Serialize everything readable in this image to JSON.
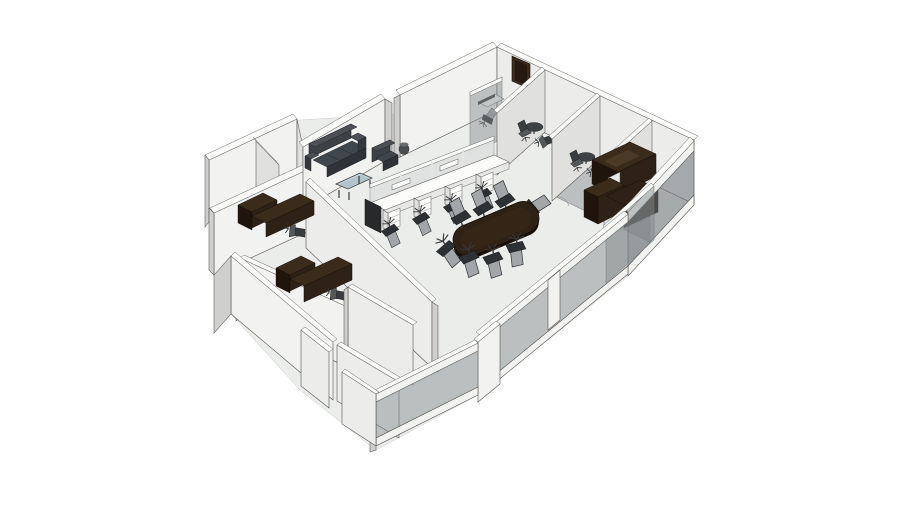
{
  "window": {
    "background": "#ffffff",
    "content": "3D axonometric rendering of an office floor-plan model on a plain white background, no text or UI chrome visible"
  },
  "colors": {
    "background": "#ffffff",
    "floor": "#ebedeb",
    "wallFace": "#f2f2f1",
    "wallLit": "#ececeb",
    "wallShade": "#cfcfce",
    "wallTop": "#fbfbfa",
    "outline": "#55534f",
    "glass": "#868b8e",
    "darkWood": "#2e2115",
    "darkWoodFront": "#1f150c",
    "sofa": "#41464b",
    "chairBack": "#a2a6a9",
    "chairSeat": "#2e3133",
    "glassTableTop": "#c6d3dc",
    "doorOpening": "#3a2a1c"
  },
  "scene": {
    "view": "isometric-perspective from the south-east, model floats on white",
    "building": {
      "walls": "white partition walls with thin dark edges",
      "front_walls": "low walls with large tinted glass panels",
      "door_opening": "dark doorway in the rear north-east wall"
    },
    "areas": [
      {
        "name": "lounge",
        "items": [
          "three-seat dark sofa",
          "dark armchair",
          "glass coffee table",
          "round waste bin"
        ]
      },
      {
        "name": "open-plan-bench",
        "workstations": 4,
        "task_chairs": 4,
        "items": [
          "white bench desks",
          "divider screens",
          "drawer pedestals",
          "dark end panel"
        ]
      },
      {
        "name": "conference-area",
        "table": "dark racetrack conference table on white panel legs",
        "chairs": 8
      },
      {
        "name": "meeting-room-1",
        "items": [
          "small desk",
          "task chair",
          "glass front"
        ]
      },
      {
        "name": "meeting-room-2",
        "items": [
          "round table",
          "2 chairs",
          "glass front"
        ]
      },
      {
        "name": "meeting-room-3",
        "items": [
          "round table",
          "2 chairs",
          "glass front"
        ]
      },
      {
        "name": "executive-office",
        "items": [
          "dark wood U-shaped desk",
          "dark pedestal",
          "glass walls"
        ]
      },
      {
        "name": "private-office-1",
        "items": [
          "dark wood desk with hutch",
          "task chair"
        ]
      },
      {
        "name": "private-office-2",
        "items": [
          "dark wood desk with hutch",
          "task chair"
        ]
      },
      {
        "name": "north-west-rooms",
        "count": 2,
        "items": []
      },
      {
        "name": "entrance-corridor",
        "items": []
      }
    ]
  }
}
